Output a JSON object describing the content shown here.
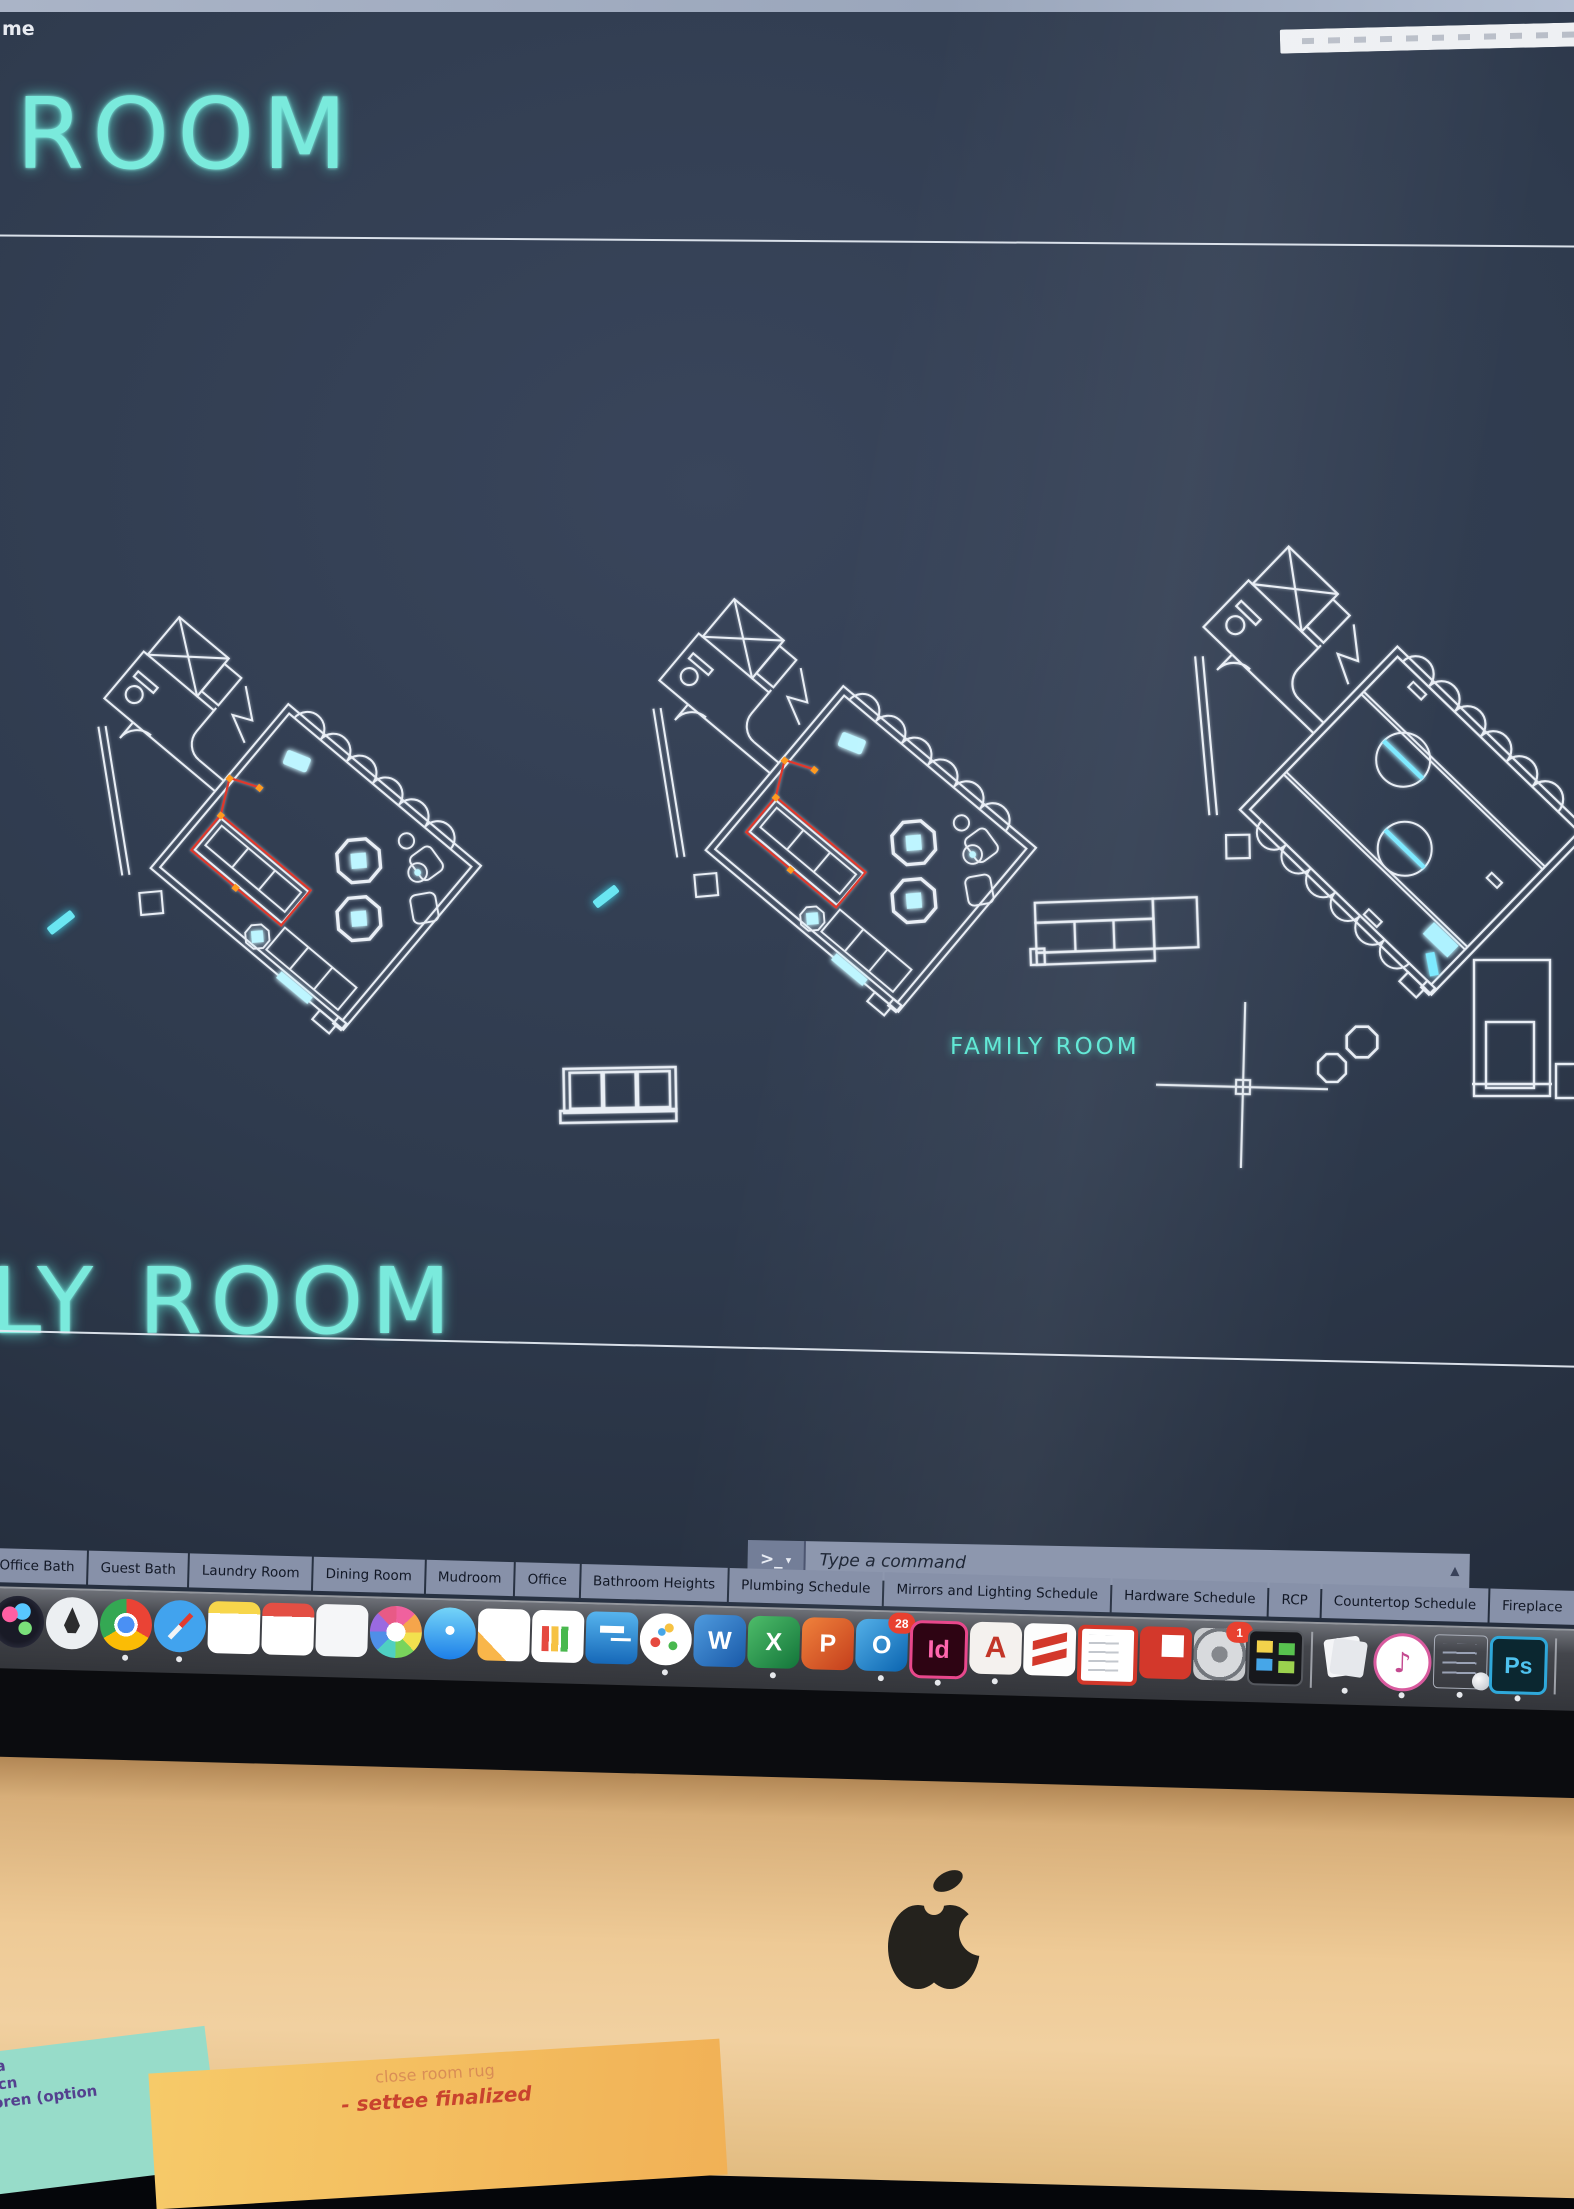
{
  "window": {
    "menu_fragment": "me"
  },
  "canvas": {
    "sheet_title_top": "ROOM",
    "sheet_title_bottom": "LY ROOM",
    "room_label": "FAMILY ROOM"
  },
  "command_bar": {
    "prompt_symbol": ">_",
    "dropdown_symbol": "▾",
    "placeholder": "Type a command",
    "expand_symbol": "▲"
  },
  "layout_tabs": {
    "tabs": [
      "Office Bath",
      "Guest Bath",
      "Laundry Room",
      "Dining Room",
      "Mudroom",
      "Office",
      "Bathroom Heights",
      "Plumbing Schedule",
      "Mirrors and Lighting Schedule",
      "Hardware Schedule",
      "RCP",
      "Countertop Schedule",
      "Fireplace"
    ],
    "scroll_left_symbol": "<"
  },
  "dock": {
    "items": [
      {
        "name": "siri"
      },
      {
        "name": "launchpad"
      },
      {
        "name": "chrome",
        "running": true
      },
      {
        "name": "safari",
        "running": true
      },
      {
        "name": "notes"
      },
      {
        "name": "calendar"
      },
      {
        "name": "reminders"
      },
      {
        "name": "photos"
      },
      {
        "name": "messages"
      },
      {
        "name": "pages"
      },
      {
        "name": "numbers"
      },
      {
        "name": "keynote"
      },
      {
        "name": "dots-app",
        "running": true
      },
      {
        "name": "word",
        "label": "W"
      },
      {
        "name": "excel",
        "label": "X",
        "running": true
      },
      {
        "name": "powerpoint",
        "label": "P"
      },
      {
        "name": "outlook",
        "label": "O",
        "badge": "28",
        "running": true
      },
      {
        "name": "indesign",
        "label": "Id",
        "running": true
      },
      {
        "name": "autocad",
        "label": "A",
        "running": true
      },
      {
        "name": "sketchup",
        "running": true
      },
      {
        "name": "stickies"
      },
      {
        "name": "layout"
      },
      {
        "name": "system-preferences",
        "badge": "1"
      },
      {
        "name": "color-panels"
      },
      {
        "divider": true
      },
      {
        "name": "document-stack",
        "running": true
      },
      {
        "name": "music",
        "running": true
      },
      {
        "name": "mail-stack",
        "running": true
      },
      {
        "name": "photoshop",
        "label": "Ps",
        "running": true
      },
      {
        "divider": true
      }
    ]
  },
  "sticky_notes": {
    "teal_lines": [
      "ota",
      "orcn",
      "noren (option",
      "t)"
    ],
    "yellow_lines": [
      "close room rug",
      "- settee finalized"
    ]
  },
  "colors": {
    "canvas_bg": "#2f3b4e",
    "cad_cyan": "#64e7d8",
    "cad_white": "#e9eef5",
    "selection_red": "#e0382c",
    "grip_orange": "#ff9a1f",
    "tab_bg": "#8791a9",
    "chin_gold": "#eeca96"
  }
}
